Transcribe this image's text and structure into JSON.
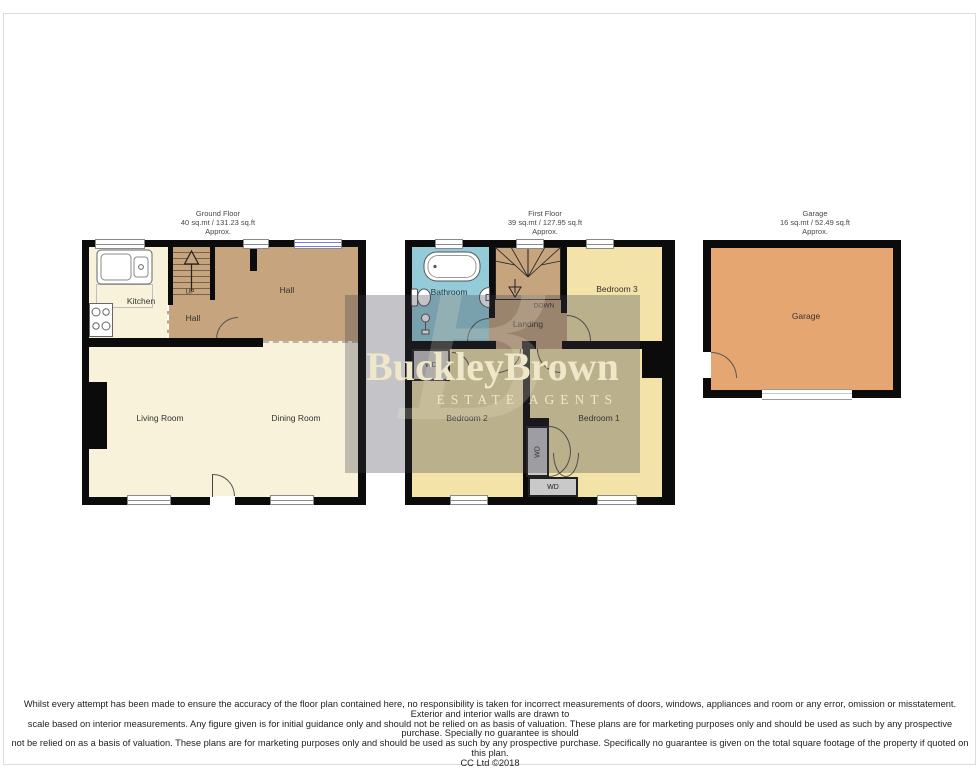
{
  "branding": {
    "name": "BuckleyBrown",
    "tagline": "ESTATE AGENTS",
    "monogram": "B"
  },
  "colors": {
    "wall": "#0b0b0b",
    "ground_cream": "#f8f2da",
    "hall_brown": "#c5a47e",
    "bedroom_yellow": "#f3e3a9",
    "bathroom_blue": "#93ccd8",
    "garage_orange": "#e5a671",
    "closet_gray": "#c9c9c9",
    "watermark_overlay": "rgba(60,58,72,0.30)",
    "watermark_text": "#efe7c9"
  },
  "floors": {
    "ground": {
      "title": "Ground Floor",
      "area": "40 sq.mt / 131.23 sq.ft",
      "approx": "Approx.",
      "stairs_label": "UP",
      "rooms": {
        "kitchen": "Kitchen",
        "hall_small": "Hall",
        "hall": "Hall",
        "living": "Living Room",
        "dining": "Dining Room"
      }
    },
    "first": {
      "title": "First Floor",
      "area": "39 sq.mt / 127.95 sq.ft",
      "approx": "Approx.",
      "stairs_label": "DOWN",
      "rooms": {
        "bathroom": "Bathroom",
        "landing": "Landing",
        "bedroom1": "Bedroom 1",
        "bedroom2": "Bedroom 2",
        "bedroom3": "Bedroom 3",
        "closet": "WD"
      }
    },
    "garage": {
      "title": "Garage",
      "area": "16 sq.mt / 52.49 sq.ft",
      "approx": "Approx.",
      "rooms": {
        "garage": "Garage"
      }
    }
  },
  "disclaimer": {
    "line1": "Whilst every attempt has been made to ensure the accuracy of the floor plan contained here, no responsibility is taken for incorrect measurements of doors, windows, appliances and room or any error, omission or misstatement. Exterior and interior walls are drawn to",
    "line2": "scale based on interior measurements. Any figure given is for initial guidance only and should not be relied on as basis of valuation. These plans are for marketing purposes only and should be used as such by any prospective purchase. Specially no guarantee is should",
    "line3": "not be relied on as a basis of valuation. These plans are for marketing purposes only and should be used as such by any prospective purchase. Specifically no guarantee is given on the total square footage of the property if quoted on this plan.",
    "copyright": "CC Ltd ©2018"
  }
}
